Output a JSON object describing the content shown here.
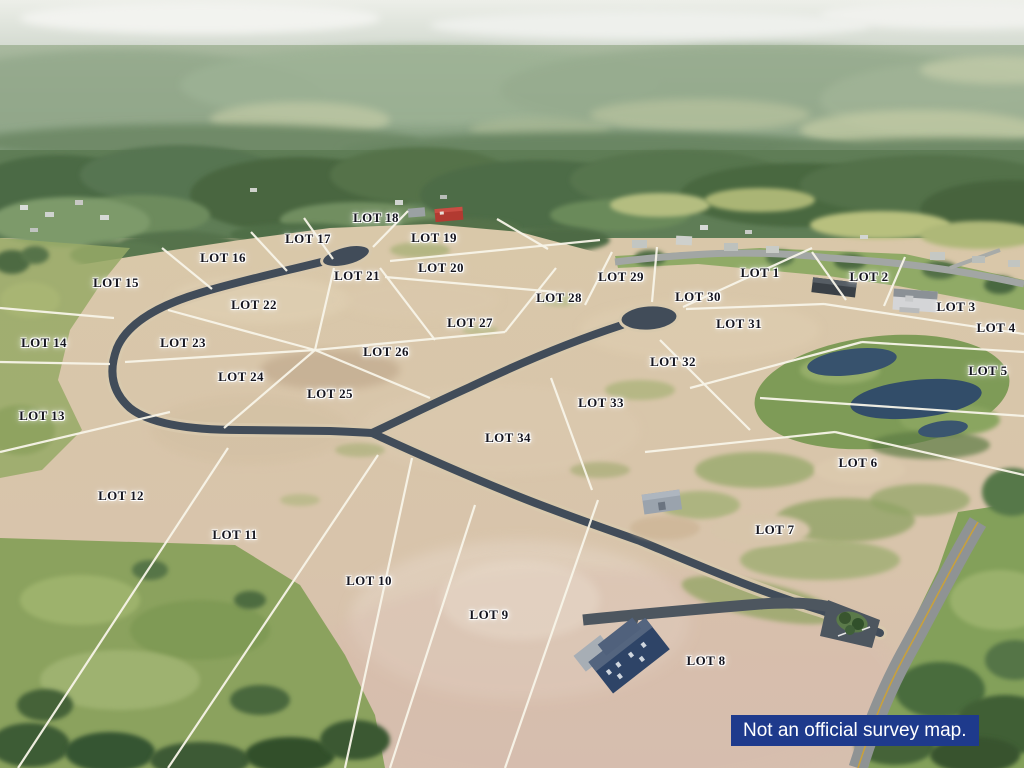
{
  "map": {
    "disclaimer": {
      "text": "Not an official survey map."
    },
    "colors": {
      "label_text": "#15151f",
      "label_halo": "#ffffff",
      "boundary_line": "#f8f5e9",
      "road_asphalt": "#414c59",
      "main_road": "#8f9394",
      "disclaimer_bg": "#1e3a8c",
      "disclaimer_text": "#ffffff",
      "pond_water": "#324d69"
    },
    "labels": [
      {
        "text": "LOT 1",
        "x": 760,
        "y": 273
      },
      {
        "text": "LOT 2",
        "x": 869,
        "y": 277
      },
      {
        "text": "LOT 3",
        "x": 956,
        "y": 307
      },
      {
        "text": "LOT 4",
        "x": 996,
        "y": 328
      },
      {
        "text": "LOT 5",
        "x": 988,
        "y": 371
      },
      {
        "text": "LOT 6",
        "x": 858,
        "y": 463
      },
      {
        "text": "LOT 7",
        "x": 775,
        "y": 530
      },
      {
        "text": "LOT 8",
        "x": 706,
        "y": 661
      },
      {
        "text": "LOT 9",
        "x": 489,
        "y": 615
      },
      {
        "text": "LOT 10",
        "x": 369,
        "y": 581
      },
      {
        "text": "LOT 11",
        "x": 235,
        "y": 535
      },
      {
        "text": "LOT 12",
        "x": 121,
        "y": 496
      },
      {
        "text": "LOT 13",
        "x": 42,
        "y": 416
      },
      {
        "text": "LOT 14",
        "x": 44,
        "y": 343
      },
      {
        "text": "LOT 15",
        "x": 116,
        "y": 283
      },
      {
        "text": "LOT 16",
        "x": 223,
        "y": 258
      },
      {
        "text": "LOT 17",
        "x": 308,
        "y": 239
      },
      {
        "text": "LOT 18",
        "x": 376,
        "y": 218
      },
      {
        "text": "LOT 19",
        "x": 434,
        "y": 238
      },
      {
        "text": "LOT 20",
        "x": 441,
        "y": 268
      },
      {
        "text": "LOT 21",
        "x": 357,
        "y": 276
      },
      {
        "text": "LOT 22",
        "x": 254,
        "y": 305
      },
      {
        "text": "LOT 23",
        "x": 183,
        "y": 343
      },
      {
        "text": "LOT 24",
        "x": 241,
        "y": 377
      },
      {
        "text": "LOT 25",
        "x": 330,
        "y": 394
      },
      {
        "text": "LOT 26",
        "x": 386,
        "y": 352
      },
      {
        "text": "LOT 27",
        "x": 470,
        "y": 323
      },
      {
        "text": "LOT 28",
        "x": 559,
        "y": 298
      },
      {
        "text": "LOT 29",
        "x": 621,
        "y": 277
      },
      {
        "text": "LOT 30",
        "x": 698,
        "y": 297
      },
      {
        "text": "LOT 31",
        "x": 739,
        "y": 324
      },
      {
        "text": "LOT 32",
        "x": 673,
        "y": 362
      },
      {
        "text": "LOT 33",
        "x": 601,
        "y": 403
      },
      {
        "text": "LOT 34",
        "x": 508,
        "y": 438
      }
    ],
    "lot_lines": [
      [
        162,
        248,
        212,
        289
      ],
      [
        251,
        232,
        287,
        271
      ],
      [
        304,
        218,
        333,
        259
      ],
      [
        408,
        211,
        373,
        247
      ],
      [
        390,
        261,
        600,
        240
      ],
      [
        497,
        219,
        548,
        249
      ],
      [
        385,
        277,
        556,
        292
      ],
      [
        0,
        308,
        114,
        318
      ],
      [
        0,
        362,
        110,
        364
      ],
      [
        0,
        452,
        170,
        412
      ],
      [
        228,
        448,
        18,
        768
      ],
      [
        378,
        455,
        168,
        768
      ],
      [
        412,
        458,
        345,
        768
      ],
      [
        475,
        505,
        390,
        768
      ],
      [
        598,
        500,
        505,
        768
      ],
      [
        168,
        310,
        315,
        350
      ],
      [
        125,
        362,
        315,
        350
      ],
      [
        315,
        350,
        224,
        428
      ],
      [
        315,
        350,
        430,
        398
      ],
      [
        315,
        350,
        505,
        332
      ],
      [
        334,
        268,
        315,
        350
      ],
      [
        380,
        268,
        435,
        340
      ],
      [
        556,
        268,
        505,
        332
      ],
      [
        612,
        252,
        585,
        305
      ],
      [
        551,
        378,
        592,
        490
      ],
      [
        657,
        247,
        652,
        302
      ],
      [
        812,
        248,
        683,
        307
      ],
      [
        812,
        252,
        846,
        300
      ],
      [
        905,
        257,
        884,
        306
      ],
      [
        686,
        309,
        824,
        304
      ],
      [
        824,
        304,
        1024,
        334
      ],
      [
        690,
        388,
        862,
        342
      ],
      [
        862,
        342,
        1024,
        352
      ],
      [
        760,
        398,
        1024,
        416
      ],
      [
        660,
        340,
        750,
        430
      ],
      [
        645,
        452,
        835,
        432
      ],
      [
        835,
        432,
        1024,
        475
      ]
    ]
  }
}
